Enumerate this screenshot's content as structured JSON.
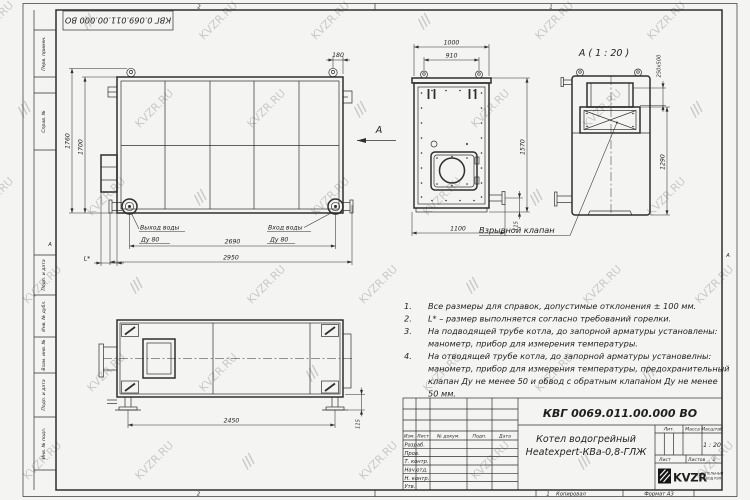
{
  "watermark": {
    "text": "KVZR.RU"
  },
  "stamp": {
    "doc_number_inverted": "КВГ 0.069.011.00.000 ВО"
  },
  "frame": {
    "zones": {
      "top_left": "2",
      "top_right": "1",
      "bottom_left": "2",
      "bottom_right": "1",
      "left": "А",
      "right": "А"
    },
    "footer": {
      "kopiroval": "Копировал",
      "format": "Формат А3"
    },
    "side_strip": [
      "Перв. примен.",
      "Справ. №",
      "Подп. и дата",
      "Инв. № дубл.",
      "Взам. инв. №",
      "Подп. и дата",
      "Инв. № подл."
    ]
  },
  "views": {
    "front": {
      "dim_1760": "1760",
      "dim_1700": "1700",
      "dim_180": "180",
      "dim_2690": "2690",
      "dim_2950": "2950",
      "dim_L": "L*",
      "outlet_label": "Выход воды",
      "outlet_dn": "Ду 80",
      "inlet_label": "Вход воды",
      "inlet_dn": "Ду 80",
      "section_mark": "А"
    },
    "side": {
      "dim_1000": "1000",
      "dim_910": "910",
      "dim_1570": "1570",
      "dim_1100": "1100",
      "dim_115": "115"
    },
    "view_a": {
      "title": "А ( 1 : 20 )",
      "dim_valve": "250х500",
      "dim_1290": "1290",
      "valve_label": "Взрывной клапан"
    },
    "plan": {
      "dim_2450": "2450",
      "dim_115": "115"
    }
  },
  "notes": {
    "items": [
      {
        "num": "1.",
        "lines": [
          "Все размеры для справок, допустимые отклонения ± 100 мм."
        ]
      },
      {
        "num": "2.",
        "lines": [
          "L* – размер выполняется согласно требований горелки."
        ]
      },
      {
        "num": "3.",
        "lines": [
          "На подводящей трубе котла, до запорной арматуры установлены:",
          "манометр, прибор для измерения температуры."
        ]
      },
      {
        "num": "4.",
        "lines": [
          "На отводящей трубе котла, до запорной арматуры установелны:",
          "манометр, прибор для измерения температуры, предохранительный",
          "клапан Ду не менее 50 и обвод с обратным клапаном Ду не менее",
          "50 мм."
        ]
      }
    ]
  },
  "title_block": {
    "doc_number": "КВГ 0069.011.00.000 ВО",
    "product_name_line1": "Котел водогрейный",
    "product_name_line2": "Heatexpert-КВа-0,8-ГЛЖ",
    "col_izm": "Изм.",
    "col_list": "Лист",
    "col_doc": "№ докум.",
    "col_podp": "Подп.",
    "col_data": "Дата",
    "row_razrab": "Разраб.",
    "row_prov": "Пров.",
    "row_tkontr": "Т. контр.",
    "row_nachotd": "Нач.отд.",
    "row_nkontr": "Н. контр.",
    "row_utv": "Утв.",
    "lit": "Лит.",
    "massa": "Масса",
    "masshtab": "Масштаб",
    "scale": "1 : 20",
    "list_label": "Лист",
    "listov_label": "Листов",
    "listov_value": "1",
    "logo_text": "KVZR",
    "logo_caption_line1": "КОТЕЛЬНЫЙ",
    "logo_caption_line2": "ЗАВОД РЭП"
  },
  "colors": {
    "line": "#2f2f2f",
    "watermark": "#c9c9c9",
    "paper": "#ffffff"
  }
}
